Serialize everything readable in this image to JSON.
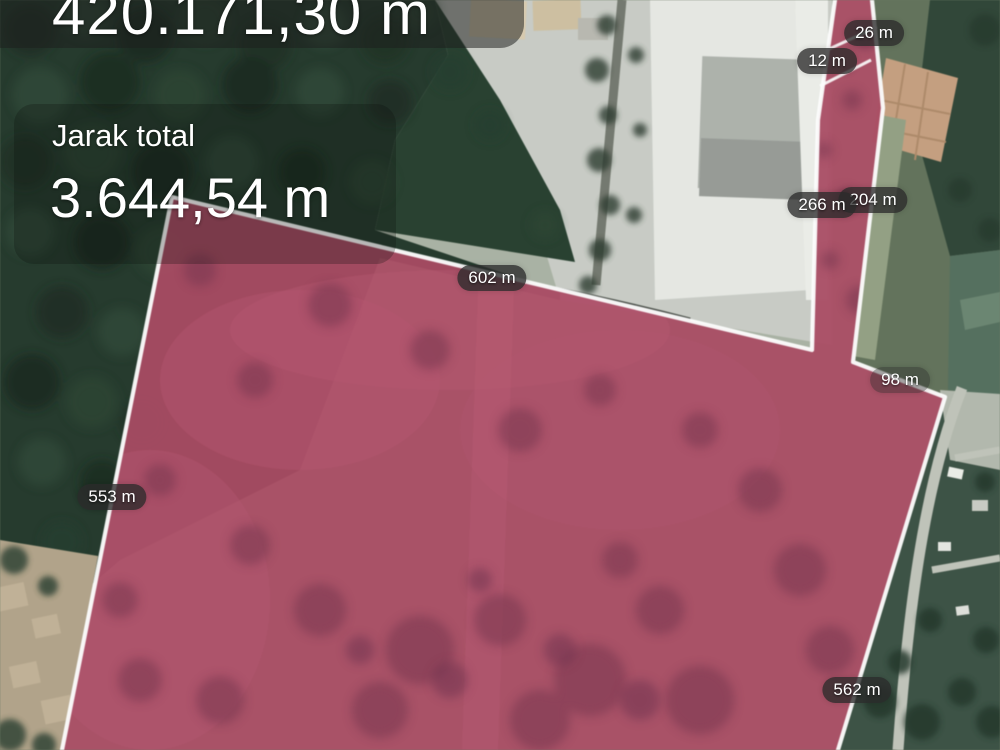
{
  "screen": {
    "type": "map-distance-measurement"
  },
  "metrics": {
    "area_clipped_text": "420.171,30 m",
    "total_distance_label": "Jarak total",
    "total_distance_value": "3.644,54 m"
  },
  "segment_labels": [
    {
      "name": "segment-26m",
      "text": "26 m"
    },
    {
      "name": "segment-12m",
      "text": "12 m"
    },
    {
      "name": "segment-204m",
      "text": "204 m"
    },
    {
      "name": "segment-266m",
      "text": "266 m"
    },
    {
      "name": "segment-602m",
      "text": "602 m"
    },
    {
      "name": "segment-98m",
      "text": "98 m"
    },
    {
      "name": "segment-553m",
      "text": "553 m"
    },
    {
      "name": "segment-562m",
      "text": "562 m"
    }
  ],
  "colors": {
    "measure_fill": "#ad4963",
    "measure_outline": "#ffffff",
    "label_pill_bg": "rgba(42,42,42,0.78)",
    "text": "#ffffff"
  }
}
